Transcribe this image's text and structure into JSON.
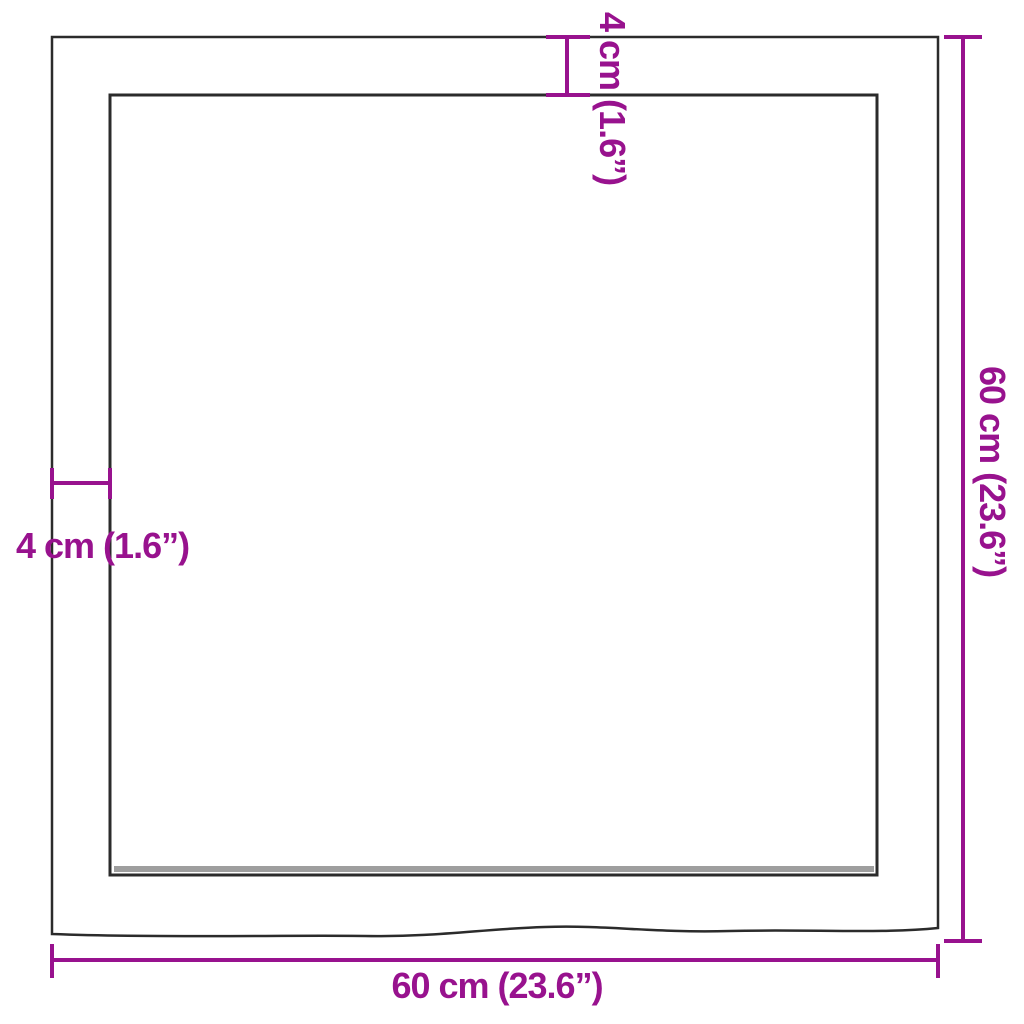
{
  "labels": {
    "top_thickness": "4 cm (1.6”)",
    "left_thickness": "4 cm (1.6”)",
    "right_height": "60 cm (23.6”)",
    "bottom_width": "60 cm (23.6”)"
  },
  "colors": {
    "dimension_accent": "#98128E",
    "board_outline": "#2b2b2b",
    "board_inner_shadow": "#8d8d8d",
    "background": "#ffffff"
  }
}
